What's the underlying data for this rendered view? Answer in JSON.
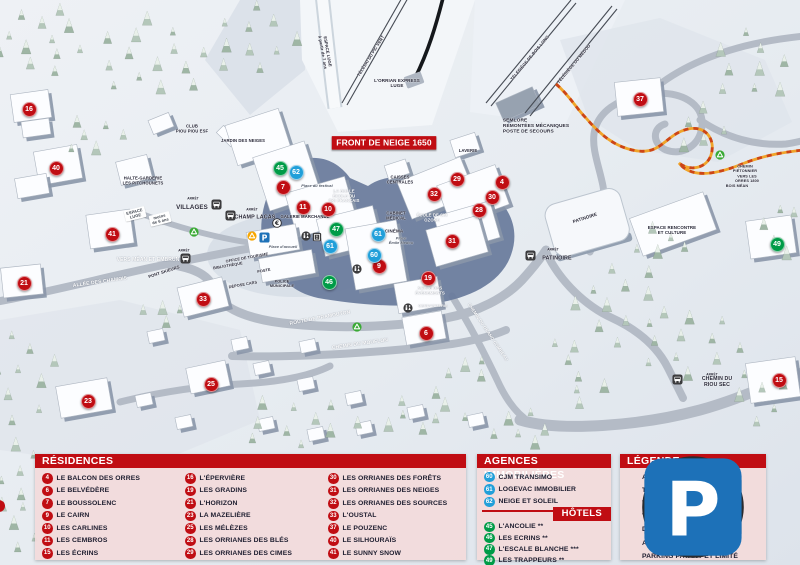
{
  "colors": {
    "marker_red": "#c00d13",
    "marker_blue": "#219fd9",
    "marker_green": "#009b47",
    "header_red": "#c00d13",
    "panel_pink": "#f2dbdb",
    "parking_blue": "#1d71b8",
    "recycle_green": "#3aaa35",
    "recycle_yellow": "#f7a600",
    "icon_dark": "#3b3b3d"
  },
  "map": {
    "banner": "FRONT DE NEIGE 1650",
    "markers": [
      {
        "n": "16",
        "c": "red",
        "x": 28,
        "y": 108
      },
      {
        "n": "40",
        "c": "red",
        "x": 55,
        "y": 167
      },
      {
        "n": "41",
        "c": "red",
        "x": 111,
        "y": 233
      },
      {
        "n": "21",
        "c": "red",
        "x": 23,
        "y": 282
      },
      {
        "n": "33",
        "c": "red",
        "x": 202,
        "y": 298
      },
      {
        "n": "23",
        "c": "red",
        "x": 87,
        "y": 400
      },
      {
        "n": "25",
        "c": "red",
        "x": 210,
        "y": 383
      },
      {
        "n": "7",
        "c": "red",
        "x": 282,
        "y": 186
      },
      {
        "n": "11",
        "c": "red",
        "x": 302,
        "y": 206
      },
      {
        "n": "10",
        "c": "red",
        "x": 327,
        "y": 208
      },
      {
        "n": "32",
        "c": "red",
        "x": 433,
        "y": 193
      },
      {
        "n": "29",
        "c": "red",
        "x": 456,
        "y": 178
      },
      {
        "n": "4",
        "c": "red",
        "x": 501,
        "y": 181
      },
      {
        "n": "30",
        "c": "red",
        "x": 491,
        "y": 196
      },
      {
        "n": "28",
        "c": "red",
        "x": 478,
        "y": 209
      },
      {
        "n": "31",
        "c": "red",
        "x": 451,
        "y": 240
      },
      {
        "n": "9",
        "c": "red",
        "x": 378,
        "y": 265
      },
      {
        "n": "19",
        "c": "red",
        "x": 427,
        "y": 277
      },
      {
        "n": "6",
        "c": "red",
        "x": 425,
        "y": 332
      },
      {
        "n": "37",
        "c": "red",
        "x": 639,
        "y": 98
      },
      {
        "n": "15",
        "c": "red",
        "x": 778,
        "y": 379
      },
      {
        "n": "62",
        "c": "blue",
        "x": 295,
        "y": 171
      },
      {
        "n": "61",
        "c": "blue",
        "x": 377,
        "y": 233
      },
      {
        "n": "60",
        "c": "blue",
        "x": 373,
        "y": 254
      },
      {
        "n": "61",
        "c": "blue",
        "x": 329,
        "y": 245
      },
      {
        "n": "45",
        "c": "green",
        "x": 279,
        "y": 167
      },
      {
        "n": "47",
        "c": "green",
        "x": 335,
        "y": 228
      },
      {
        "n": "46",
        "c": "green",
        "x": 328,
        "y": 281
      },
      {
        "n": "49",
        "c": "green",
        "x": 776,
        "y": 243
      }
    ],
    "icons": [
      {
        "k": "bus",
        "x": 216,
        "y": 204
      },
      {
        "k": "bus",
        "x": 230,
        "y": 215
      },
      {
        "k": "bus",
        "x": 185,
        "y": 258
      },
      {
        "k": "bus",
        "x": 530,
        "y": 255
      },
      {
        "k": "bus",
        "x": 677,
        "y": 379
      },
      {
        "k": "parking",
        "x": 264,
        "y": 237
      },
      {
        "k": "recycle-yellow",
        "x": 252,
        "y": 236
      },
      {
        "k": "recycle-green",
        "x": 194,
        "y": 232
      },
      {
        "k": "recycle-green",
        "x": 357,
        "y": 327
      },
      {
        "k": "recycle-green",
        "x": 720,
        "y": 155
      },
      {
        "k": "toilet",
        "x": 306,
        "y": 236
      },
      {
        "k": "elevator",
        "x": 317,
        "y": 237
      },
      {
        "k": "toilet",
        "x": 357,
        "y": 269
      },
      {
        "k": "toilet",
        "x": 408,
        "y": 308
      },
      {
        "k": "atm",
        "x": 277,
        "y": 223
      }
    ],
    "labels": [
      {
        "t": "ESPACE LUGE\nà partir de 7 ans",
        "x": 325,
        "y": 52,
        "fs": 4.2,
        "r": 80
      },
      {
        "t": "TÉLÉSKI DU PIC VERT",
        "x": 371,
        "y": 56,
        "fs": 4.2,
        "r": -58
      },
      {
        "t": "L'ORRIAN EXPRESS\nLUGE",
        "x": 397,
        "y": 83,
        "fs": 4.5
      },
      {
        "t": "TÉLÉSIÈGE DE BOIS LONG",
        "x": 530,
        "y": 58,
        "fs": 4.2,
        "r": -50
      },
      {
        "t": "TÉLÉSIÈGE DU MÉDOU",
        "x": 574,
        "y": 64,
        "fs": 4.2,
        "r": -50
      },
      {
        "t": "SEMLORE\nREMONTÉES MÉCANIQUES\nPOSTE DE SECOURS",
        "x": 536,
        "y": 126,
        "fs": 4.8,
        "left": true
      },
      {
        "t": "FRONT DE NEIGE 1650",
        "x": 384,
        "y": 143,
        "fs": 8.5,
        "bg": "red"
      },
      {
        "t": "CLUB\nPIOU PIOU ESF",
        "x": 192,
        "y": 129,
        "fs": 4.2
      },
      {
        "t": "JARDIN DES NEIGES",
        "x": 243,
        "y": 141,
        "fs": 4.2
      },
      {
        "t": "HALTE-GARDERIE\nLES PITCHOUNETS",
        "x": 143,
        "y": 181,
        "fs": 4.2
      },
      {
        "t": "ESPACE\nLUGE",
        "x": 135,
        "y": 214,
        "fs": 4,
        "bg": "white",
        "r": -14
      },
      {
        "t": "moins\nde 6 ans",
        "x": 160,
        "y": 219,
        "fs": 4,
        "bg": "white",
        "r": -14
      },
      {
        "t": "ARRÊT",
        "x": 193,
        "y": 199,
        "fs": 3.2
      },
      {
        "t": "VILLAGES",
        "x": 192,
        "y": 207,
        "fs": 6.2
      },
      {
        "t": "ARRÊT",
        "x": 252,
        "y": 210,
        "fs": 3.2
      },
      {
        "t": "CHAMP LACAS",
        "x": 255,
        "y": 217,
        "fs": 5.4
      },
      {
        "t": "ARRÊT",
        "x": 184,
        "y": 251,
        "fs": 3.2
      },
      {
        "t": "VERS MÉAN ET EMBRUN",
        "x": 148,
        "y": 260,
        "fs": 5,
        "w": true
      },
      {
        "t": "ALLÉE DES CHAMOIS",
        "x": 100,
        "y": 282,
        "fs": 5,
        "w": true,
        "r": -8
      },
      {
        "t": "PONT SKIEURS",
        "x": 164,
        "y": 272,
        "fs": 4.2,
        "r": -18
      },
      {
        "t": "LAVERIE",
        "x": 468,
        "y": 151,
        "fs": 4.2
      },
      {
        "t": "CAISSES\nCENTRALES",
        "x": 400,
        "y": 180,
        "fs": 4.2
      },
      {
        "t": "LA BULLE\nÉCOLE DU\nSKI FRANÇAIS",
        "x": 344,
        "y": 196,
        "fs": 4.2,
        "w": true
      },
      {
        "t": "ÉCOLE DE SKI\nOZONE",
        "x": 432,
        "y": 218,
        "fs": 4.2,
        "w": true
      },
      {
        "t": "CABINET\nMÉDICAL",
        "x": 396,
        "y": 216,
        "fs": 4.2
      },
      {
        "t": "CINÉMA",
        "x": 394,
        "y": 231,
        "fs": 4.5
      },
      {
        "t": "Place\nÉmile Médou",
        "x": 401,
        "y": 241,
        "fs": 3.8,
        "i": true
      },
      {
        "t": "Place du festival",
        "x": 317,
        "y": 186,
        "fs": 3.8,
        "i": true
      },
      {
        "t": "GALERIE MARCHANDE",
        "x": 305,
        "y": 217,
        "fs": 4.2
      },
      {
        "t": "Place d'accueil",
        "x": 283,
        "y": 247,
        "fs": 3.8,
        "i": true
      },
      {
        "t": "OFFICE DE TOURISME",
        "x": 247,
        "y": 258,
        "fs": 3.8,
        "r": -10
      },
      {
        "t": "BIBLIOTHÈQUE",
        "x": 228,
        "y": 266,
        "fs": 3.8,
        "r": -10
      },
      {
        "t": "POSTE",
        "x": 264,
        "y": 271,
        "fs": 3.8,
        "r": -10
      },
      {
        "t": "DÉPOSE CARS",
        "x": 243,
        "y": 285,
        "fs": 3.8,
        "r": -10
      },
      {
        "t": "POLICE\nMUNICIPALE",
        "x": 282,
        "y": 284,
        "fs": 3.8
      },
      {
        "t": "ROUTE DE PRAMOUTON",
        "x": 320,
        "y": 318,
        "fs": 5,
        "w": true,
        "r": -11
      },
      {
        "t": "CHEMIN DU MOUFLON",
        "x": 360,
        "y": 344,
        "fs": 5,
        "w": true,
        "r": -8
      },
      {
        "t": "CHEMIN DU GRAND COMBEAU",
        "x": 488,
        "y": 332,
        "fs": 4.4,
        "w": true,
        "r": 56
      },
      {
        "t": "SALLE DES\nÉVÈNEMENTS",
        "x": 430,
        "y": 291,
        "fs": 4.2,
        "w": true
      },
      {
        "t": "GENDARMERIE",
        "x": 433,
        "y": 306,
        "fs": 3.8,
        "w": true
      },
      {
        "t": "ARRÊT",
        "x": 553,
        "y": 250,
        "fs": 3.2
      },
      {
        "t": "PATINOIRE",
        "x": 557,
        "y": 258,
        "fs": 5.4
      },
      {
        "t": "PATINOIRE",
        "x": 585,
        "y": 218,
        "fs": 4.6,
        "r": -18
      },
      {
        "t": "ESPACE RENCONTRE\nET CULTURE",
        "x": 672,
        "y": 230,
        "fs": 4.4
      },
      {
        "t": "ARRÊT",
        "x": 712,
        "y": 375,
        "fs": 3.2
      },
      {
        "t": "CHEMIN DU RIOU SEC",
        "x": 717,
        "y": 382,
        "fs": 5.2
      },
      {
        "t": "CHEMIN PIÉTONNIER →",
        "x": 745,
        "y": 171,
        "fs": 3.8
      },
      {
        "t": "VERS LES ORRES 1800",
        "x": 747,
        "y": 179,
        "fs": 3.8
      },
      {
        "t": "BOIS MÉAN",
        "x": 737,
        "y": 186,
        "fs": 3.8
      }
    ]
  },
  "panels": {
    "residences": {
      "title": "RÉSIDENCES",
      "columns": [
        [
          {
            "n": "4",
            "label": "LE BALCON DES ORRES"
          },
          {
            "n": "6",
            "label": "LE BELVÉDÈRE"
          },
          {
            "n": "7",
            "label": "LE BOUSSOLENC"
          },
          {
            "n": "9",
            "label": "LE CAIRN"
          },
          {
            "n": "10",
            "label": "LES CARLINES"
          },
          {
            "n": "11",
            "label": "LES CEMBROS"
          },
          {
            "n": "15",
            "label": "LES ÉCRINS"
          }
        ],
        [
          {
            "n": "16",
            "label": "L'ÉPERVIÈRE"
          },
          {
            "n": "19",
            "label": "LES GRADINS"
          },
          {
            "n": "21",
            "label": "L'HORIZON"
          },
          {
            "n": "23",
            "label": "LA MAZELIÈRE"
          },
          {
            "n": "25",
            "label": "LES MÉLÈZES"
          },
          {
            "n": "28",
            "label": "LES ORRIANES DES BLÉS"
          },
          {
            "n": "29",
            "label": "LES ORRIANES DES CIMES"
          }
        ],
        [
          {
            "n": "30",
            "label": "LES ORRIANES DES FORÊTS"
          },
          {
            "n": "31",
            "label": "LES ORRIANES DES NEIGES"
          },
          {
            "n": "32",
            "label": "LES ORRIANES DES SOURCES"
          },
          {
            "n": "33",
            "label": "L'OUSTAL"
          },
          {
            "n": "37",
            "label": "LE POUZENC"
          },
          {
            "n": "40",
            "label": "LE SILHOURAÏS"
          },
          {
            "n": "41",
            "label": "LE SUNNY SNOW"
          }
        ]
      ]
    },
    "agences": {
      "title": "AGENCES IMMOBILIÈRES",
      "items": [
        {
          "n": "60",
          "label": "CJM TRANSIMO"
        },
        {
          "n": "61",
          "label": "LOGEVAC IMMOBILIER"
        },
        {
          "n": "62",
          "label": "NEIGE ET SOLEIL"
        }
      ],
      "hotels_title": "HÔTELS",
      "hotels": [
        {
          "n": "45",
          "label": "L'ANCOLIE **"
        },
        {
          "n": "46",
          "label": "LES ECRINS **"
        },
        {
          "n": "47",
          "label": "L'ESCALE BLANCHE ***"
        },
        {
          "n": "49",
          "label": "LES TRAPPEURS **"
        }
      ]
    },
    "legende": {
      "title": "LÉGENDE",
      "items": [
        {
          "icon": "bus",
          "label": "ARRET DE NAVETTE"
        },
        {
          "icon": "recycle-green",
          "label": "TRI SELECTIF"
        },
        {
          "icon": "recycle-yellow",
          "label": "TRI SELECTIF + VERRE"
        },
        {
          "icon": "toilet",
          "label": "TOILETTE"
        },
        {
          "icon": "atm",
          "label": "DISTRIBUTEUR DE BILLETS"
        },
        {
          "icon": "elevator",
          "label": "ASCENSEUR"
        },
        {
          "icon": "parking",
          "label": "PARKING PAYANT ET LIMITÉ"
        }
      ]
    }
  }
}
